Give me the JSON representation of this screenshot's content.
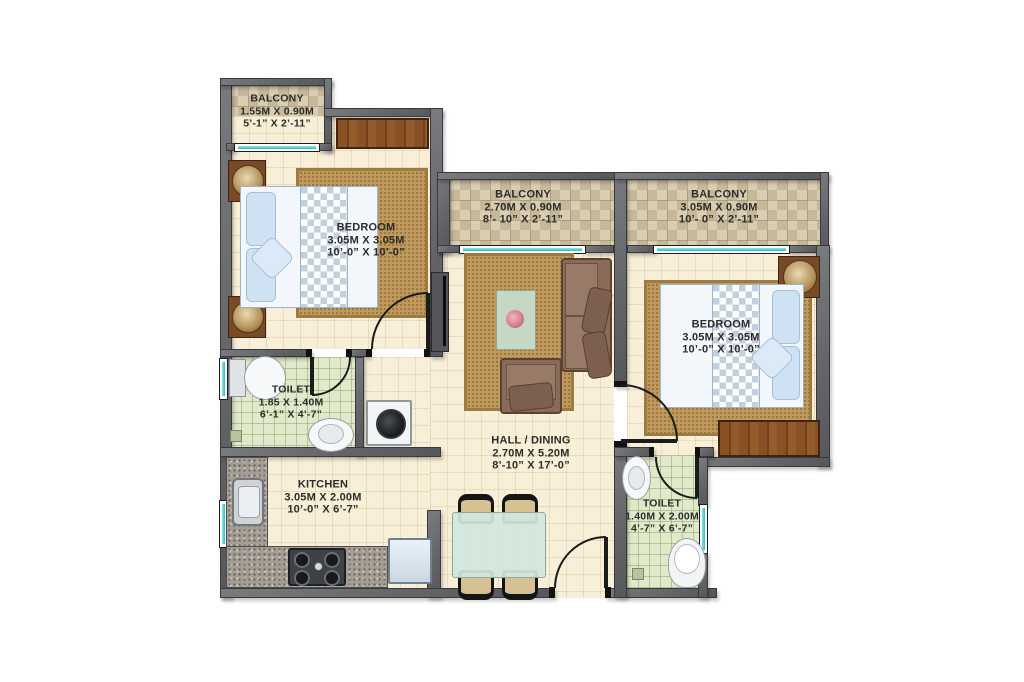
{
  "plan_type": "residential-floor-plan",
  "rooms": [
    {
      "id": "balcony-top-left",
      "name": "BALCONY",
      "metric": "1.55M X 0.90M",
      "imperial": "5’-1” X 2’-11”"
    },
    {
      "id": "bedroom-1",
      "name": "BEDROOM",
      "metric": "3.05M X 3.05M",
      "imperial": "10’-0” X 10’-0”"
    },
    {
      "id": "balcony-middle",
      "name": "BALCONY",
      "metric": "2.70M X 0.90M",
      "imperial": "8’- 10” X 2’-11”"
    },
    {
      "id": "balcony-right",
      "name": "BALCONY",
      "metric": "3.05M X 0.90M",
      "imperial": "10’- 0” X 2’-11”"
    },
    {
      "id": "bedroom-2",
      "name": "BEDROOM",
      "metric": "3.05M X 3.05M",
      "imperial": "10’-0” X 10’-0”"
    },
    {
      "id": "toilet-1",
      "name": "TOILET",
      "metric": "1.85 X 1.40M",
      "imperial": "6’-1” X 4’-7”"
    },
    {
      "id": "kitchen",
      "name": "KITCHEN",
      "metric": "3.05M X 2.00M",
      "imperial": "10’-0” X 6’-7”"
    },
    {
      "id": "hall-dining",
      "name": "HALL / DINING",
      "metric": "2.70M X 5.20M",
      "imperial": "8’-10” X 17’-0”"
    },
    {
      "id": "toilet-2",
      "name": "TOILET",
      "metric": "1.40M X 2.00M",
      "imperial": "4’-7” X 6’-7”"
    }
  ],
  "furniture_icons": [
    "double-bed",
    "wardrobe",
    "nightstand-with-lamp",
    "sofa",
    "armchair",
    "coffee-table-with-flowers",
    "tv-unit",
    "dining-table",
    "dining-chair",
    "refrigerator",
    "kitchen-counter",
    "kitchen-sink",
    "gas-stove",
    "washing-machine",
    "toilet-wc",
    "washbasin",
    "floor-drain",
    "window",
    "door-swing",
    "rug"
  ],
  "colors": {
    "wall": "#646569",
    "floor": "#f8efd9",
    "balcony_tile": "#d9cdb2",
    "toilet_tile": "#e0e9cb",
    "window_glass": "#35b9c1",
    "rug": "#c09a5d",
    "wood": "#8a5126",
    "sofa": "#8c6e5d",
    "bedding": "#cfe2f3"
  }
}
